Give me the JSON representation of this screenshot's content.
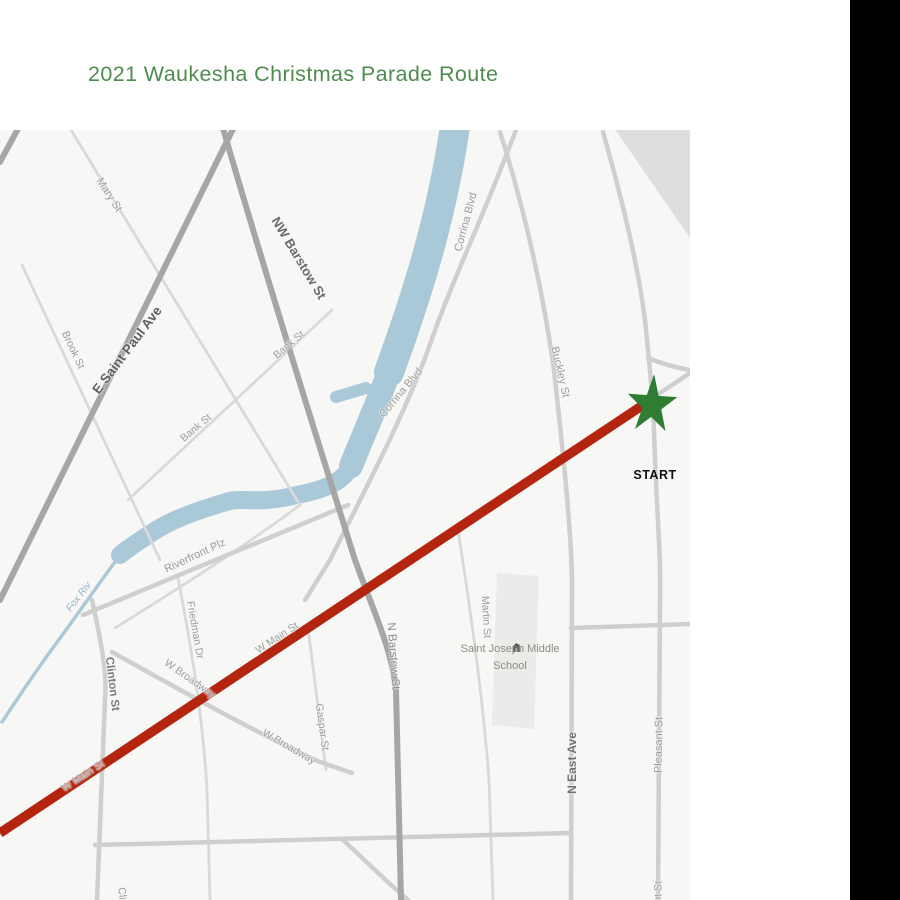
{
  "header": {
    "title": "2021 Waukesha Christmas Parade Route",
    "color": "#4f8b4f"
  },
  "panel": {
    "right_bar_color": "#000000"
  },
  "map": {
    "background": "#f7f7f5",
    "river_color": "#a9c8d8",
    "stream_color": "#abc9d9",
    "route": {
      "color": "#b3250e"
    },
    "start": {
      "label": "START",
      "star_color": "#2e7d32"
    },
    "school": {
      "name_line1": "Saint Joseph Middle",
      "name_line2": "School",
      "icon": "school-building-icon"
    },
    "street_labels": [
      {
        "text": "Mary St",
        "x": 109,
        "y": 65,
        "rot": 57,
        "size": 11,
        "color": "#9c9c9c"
      },
      {
        "text": "NW Barstow St",
        "x": 299,
        "y": 128,
        "rot": 59,
        "size": 13,
        "color": "#6a6a6a",
        "weight": 700
      },
      {
        "text": "E Saint Paul Ave",
        "x": 127,
        "y": 220,
        "rot": -53,
        "size": 13.5,
        "color": "#5f5f5f",
        "weight": 700
      },
      {
        "text": "Brook St",
        "x": 73,
        "y": 220,
        "rot": 65,
        "size": 10.5,
        "color": "#9c9c9c"
      },
      {
        "text": "Bank St",
        "x": 289,
        "y": 215,
        "rot": -40,
        "size": 10.5,
        "color": "#9c9c9c"
      },
      {
        "text": "Bank St",
        "x": 196,
        "y": 298,
        "rot": -40,
        "size": 10.5,
        "color": "#9c9c9c"
      },
      {
        "text": "Corrina Blvd",
        "x": 466,
        "y": 92,
        "rot": -75,
        "size": 11,
        "color": "#9c9c9c"
      },
      {
        "text": "Corrina Blvd",
        "x": 401,
        "y": 263,
        "rot": -50,
        "size": 11,
        "color": "#9c9c9c"
      },
      {
        "text": "Buckley St",
        "x": 560,
        "y": 242,
        "rot": 77,
        "size": 11,
        "color": "#9c9c9c"
      },
      {
        "text": "Riverfront Plz",
        "x": 195,
        "y": 426,
        "rot": -25,
        "size": 11,
        "color": "#9c9c9c"
      },
      {
        "text": "Fox Riv",
        "x": 79,
        "y": 467,
        "rot": -52,
        "size": 10,
        "color": "#93b3c6",
        "style": "italic"
      },
      {
        "text": "Clinton St",
        "x": 112,
        "y": 554,
        "rot": 83,
        "size": 11.5,
        "color": "#7d7d7d",
        "weight": 600
      },
      {
        "text": "Friedman Dr",
        "x": 195,
        "y": 500,
        "rot": 80,
        "size": 10.5,
        "color": "#9c9c9c"
      },
      {
        "text": "W Broadway",
        "x": 190,
        "y": 549,
        "rot": 35,
        "size": 10.5,
        "color": "#9c9c9c"
      },
      {
        "text": "W Broadway",
        "x": 289,
        "y": 617,
        "rot": 30,
        "size": 10.5,
        "color": "#9c9c9c"
      },
      {
        "text": "W Main St",
        "x": 83,
        "y": 646,
        "rot": -33,
        "size": 10.5,
        "color": "#a0a0a0"
      },
      {
        "text": "W Main St",
        "x": 277,
        "y": 508,
        "rot": -33,
        "size": 10.5,
        "color": "#a0a0a0"
      },
      {
        "text": "Gaspar St",
        "x": 322,
        "y": 597,
        "rot": 82,
        "size": 10.5,
        "color": "#9c9c9c"
      },
      {
        "text": "N Barstow St",
        "x": 393,
        "y": 526,
        "rot": 86,
        "size": 11.5,
        "color": "#8a8a8a"
      },
      {
        "text": "Martin St",
        "x": 486,
        "y": 487,
        "rot": 87,
        "size": 10.5,
        "color": "#9c9c9c"
      },
      {
        "text": "N East Ave",
        "x": 572,
        "y": 633,
        "rot": -90,
        "size": 12,
        "color": "#707070",
        "weight": 700
      },
      {
        "text": "Pleasant St",
        "x": 659,
        "y": 615,
        "rot": -89,
        "size": 11,
        "color": "#9c9c9c"
      },
      {
        "text": "Clinton St",
        "x": 124,
        "y": 780,
        "rot": 83,
        "size": 10.5,
        "color": "#9c9c9c"
      },
      {
        "text": "Pleasant St",
        "x": 658,
        "y": 778,
        "rot": -89,
        "size": 10.5,
        "color": "#9c9c9c"
      }
    ]
  }
}
